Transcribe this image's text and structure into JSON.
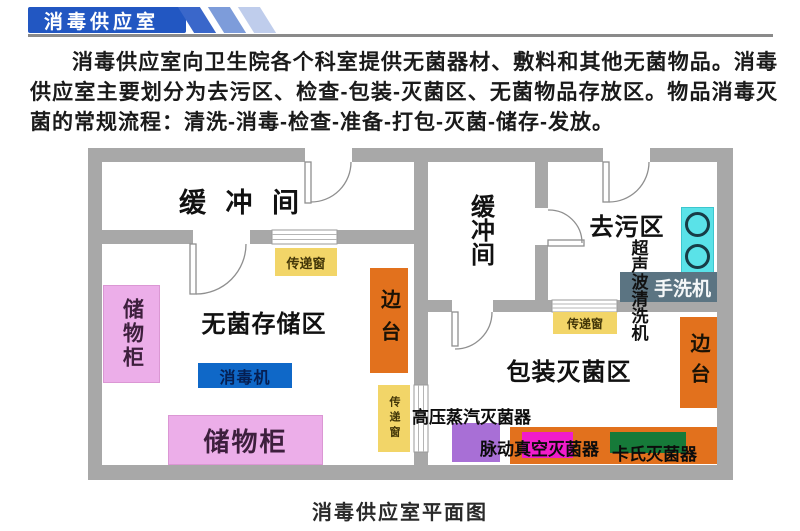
{
  "header": {
    "title": "消毒供应室"
  },
  "intro": {
    "text": "消毒供应室向卫生院各个科室提供无菌器材、敷料和其他无菌物品。消毒供应室主要划分为去污区、检查-包装-灭菌区、无菌物品存放区。物品消毒灭菌的常规流程：清洗-消毒-检查-准备-打包-灭菌-储存-发放。"
  },
  "plan": {
    "caption": "消毒供应室平面图",
    "rooms": {
      "buffer_left": "缓 冲 间",
      "buffer_right": "缓冲间",
      "sterile_storage": "无菌存储区",
      "decontamination": "去污区",
      "packing_sterilization": "包装灭菌区"
    },
    "items": {
      "cabinet_left": "储物柜",
      "cabinet_bottom": "储物柜",
      "side_table_left": "边台",
      "side_table_right": "边台",
      "pass_window_top": "传递窗",
      "pass_window_mid": "传递窗",
      "pass_window_right": "传递窗",
      "disinfector": "消毒机",
      "ultrasonic_cleaner": "超声波清洗机",
      "hand_washer": "手洗机",
      "steam_sterilizer": "高压蒸汽灭菌器",
      "vacuum_sterilizer": "脉动真空灭菌器",
      "cassette_sterilizer": "卡氏灭菌器"
    },
    "colors": {
      "wall": "#a8a8a8",
      "banner_blue": "#2257c2",
      "pass_window_yellow": "#f2d568",
      "side_table_orange": "#e2711d",
      "cabinet_pink": "#ecaee9",
      "disinfector_blue": "#0f68c8",
      "sink_cyan": "#5ae2e8",
      "hand_washer_slate": "#5b7482",
      "sterilizer_purple": "#a86fd6",
      "sterilizer_magenta": "#f11ccb",
      "sterilizer_green": "#167a39"
    }
  }
}
